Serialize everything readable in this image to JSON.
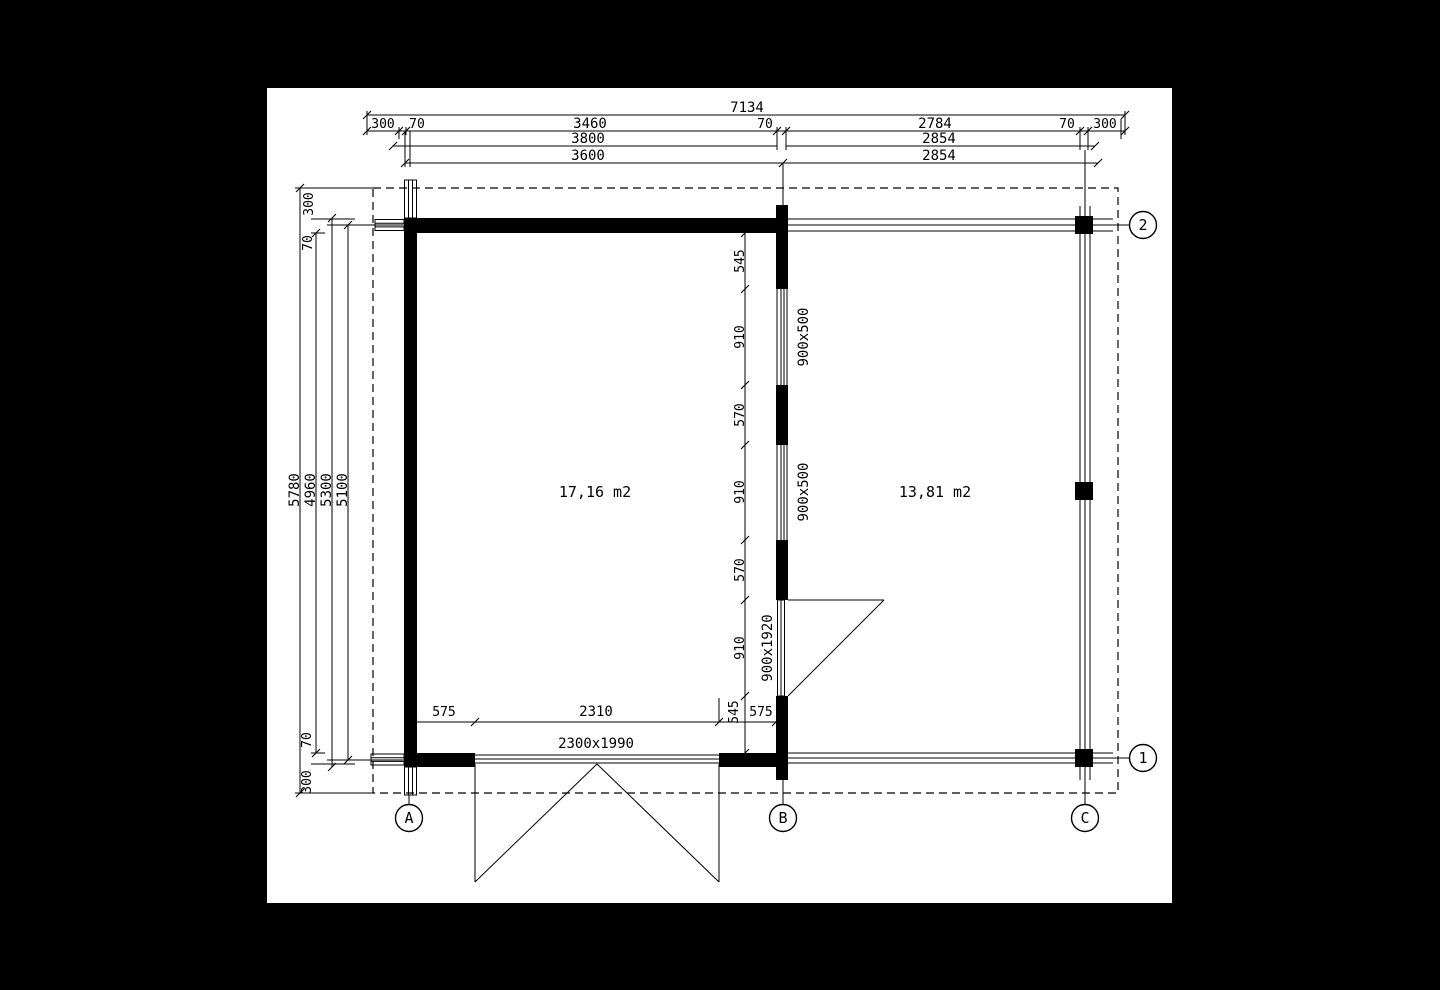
{
  "colors": {
    "ink": "#000000",
    "paper": "#ffffff"
  },
  "plan": {
    "rooms": [
      {
        "area_label": "17,16 m2"
      },
      {
        "area_label": "13,81 m2"
      }
    ],
    "axes": {
      "columns": [
        "A",
        "B",
        "C"
      ],
      "rows": [
        "1",
        "2"
      ]
    },
    "dimensions": {
      "top_total": "7134",
      "top_row2": [
        "300",
        "70",
        "3460",
        "70",
        "2784",
        "70",
        "300"
      ],
      "top_row3": [
        "3800",
        "2854"
      ],
      "top_row4": [
        "3600",
        "2854"
      ],
      "left_columns": [
        "5780",
        "4960",
        "5300",
        "5100"
      ],
      "left_top": [
        "300",
        "70"
      ],
      "left_bottom": [
        "70",
        "300"
      ],
      "wall_b_chain": [
        "545",
        "910",
        "570",
        "910",
        "570",
        "910",
        "545"
      ],
      "bottom_chain": [
        "575",
        "2310",
        "575"
      ]
    },
    "openings": {
      "window_top": "900x500",
      "window_mid": "900x500",
      "interior_door": "900x1920",
      "exterior_door": "2300x1990"
    }
  }
}
